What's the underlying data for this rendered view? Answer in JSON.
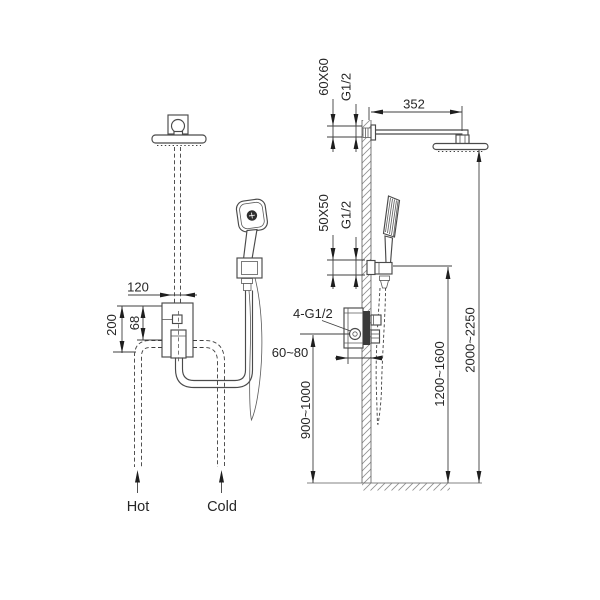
{
  "diagram": {
    "type": "technical-installation-drawing",
    "subject": "Shower system installation dimension diagram (front view and wall-mount side view)",
    "background_color": "#ffffff",
    "line_color": "#4a4a4a",
    "text_color": "#262626",
    "front_view": {
      "dim_pipe_offset": "120",
      "dim_valve_height": "200",
      "dim_diverter_offset": "68",
      "inlet_hot": "Hot",
      "inlet_cold": "Cold"
    },
    "side_view": {
      "arm_escutcheon_size": "60X60",
      "arm_thread": "G1/2",
      "arm_length": "352",
      "holder_escutcheon_size": "50X50",
      "holder_thread": "G1/2",
      "valve_connections": "4-G1/2",
      "recess_depth_range": "60~80",
      "valve_mount_height_range": "900~1000",
      "holder_mount_height_range": "1200~1600",
      "head_mount_height_range": "2000~2250"
    }
  }
}
